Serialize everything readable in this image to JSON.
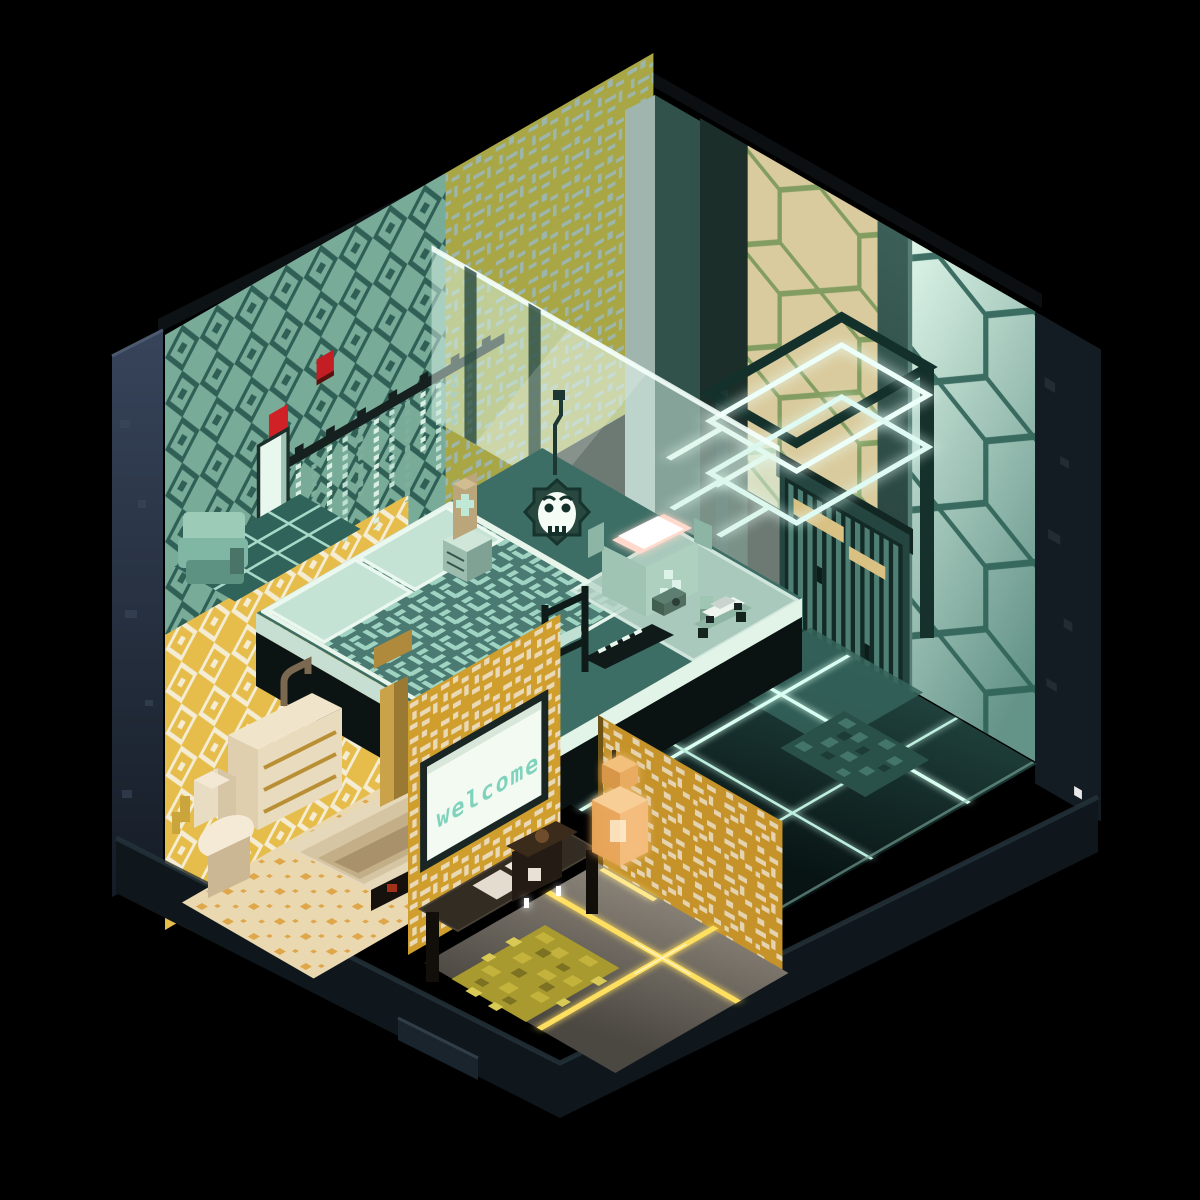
{
  "scene": {
    "title": "Voxel isometric room diorama",
    "style": "voxel art cutaway, isometric view",
    "background_color": "#000000"
  },
  "palette": {
    "teal_wallpaper": "#79ab99",
    "teal_wallpaper_motif": "#2f5f55",
    "olive_wallpaper": "#a9a645",
    "olive_wallpaper_motif": "#9db6ac",
    "tan_honeycomb_wall": "#d9cb9d",
    "tan_honeycomb_lattice": "#829d5f",
    "mint_honeycomb_wall": "#c9e9d9",
    "mint_honeycomb_lattice": "#2e6156",
    "yellow_bath_wallpaper": "#e6bd4b",
    "yellow_bath_motif": "#f4ecd3",
    "gold_entry_wallpaper": "#cf9e2d",
    "gold_entry_motif": "#ead9b7",
    "neon_glow": "#ecfff9",
    "floor_glow_yellow": "#ffdf5e",
    "floor_glow_mint": "#d8fff1",
    "bed_blanket": "#4a7a71",
    "cream_fixture": "#e8dcc2",
    "lantern_amber": "#e8a55a",
    "accent_red": "#cf2126",
    "exterior_dark": "#2b3642"
  },
  "rooms": {
    "bedroom": {
      "label": "sleeping loft",
      "wallpaper": "teal ikat diamond pattern",
      "accent_wallpaper": "olive pixel motif",
      "objects": {
        "macrame_hanging": "chevron strand wall hanging on dark rod",
        "towel_hooks": {
          "color": "red",
          "count": 2
        },
        "mirror": "tall mint panel",
        "towel_pile": "teal folded towels in shower corner",
        "bed": {
          "pillow_count": 2,
          "blanket": "teal with dashed weave pattern",
          "frame": "white platform"
        },
        "nightstand": "mint drawer unit",
        "totem_figurine": "tan block with mint cross",
        "skull_wreath": "white skull face in spiky teal wreath, hanging",
        "glass_partition": "translucent mint glass wall",
        "neon_light_frames": {
          "count": 3,
          "glow": "white-cyan"
        },
        "desk_shelf": "glass-top ledge",
        "open_box": {
          "glow": "pink interior"
        },
        "camera_toy": "small voxel camera",
        "scooter_toy": "figure on toy scooter",
        "toy_car": "white voxel car on ledge",
        "name_plaque": "dark plaque with pixel glyphs",
        "clothes_rack": "dark frame stand with mint cushion"
      }
    },
    "bathroom": {
      "wallpaper": "yellow diamond lattice",
      "floor": "cream tiles with orange motif",
      "objects": {
        "vanity": {
          "drawer_count": 3,
          "material": "cream with gold trim"
        },
        "faucet": "wall-mounted brass",
        "toilet": "cream voxel",
        "bathtub": "sunken stepped cream tub",
        "red_label": "small red mark on tub rim",
        "door_trim": "gold slatted door frame"
      }
    },
    "entry": {
      "welcome_sign": {
        "text": "welcome",
        "text_color": "#7fd2bb",
        "board_color": "#f2faf2"
      },
      "objects": {
        "console_bench": "dark wood bench",
        "towel_stacks": {
          "count": 2,
          "color": "white"
        },
        "coffee_maker": "dark body with white cup",
        "pendant_lantern": "amber glowing voxel lantern",
        "area_rug": {
          "color": "olive shag"
        },
        "floor": {
          "glow_lines": "yellow crossing light lines"
        }
      }
    },
    "hallway": {
      "objects": {
        "slatted_door": "teal vertical-slat door",
        "door_sign": "tan plaque above door",
        "doormat": "teal shaggy mat",
        "wall": "mint honeycomb tile",
        "floor": {
          "glow_grid": "mint light grid on dark floor"
        }
      }
    }
  }
}
